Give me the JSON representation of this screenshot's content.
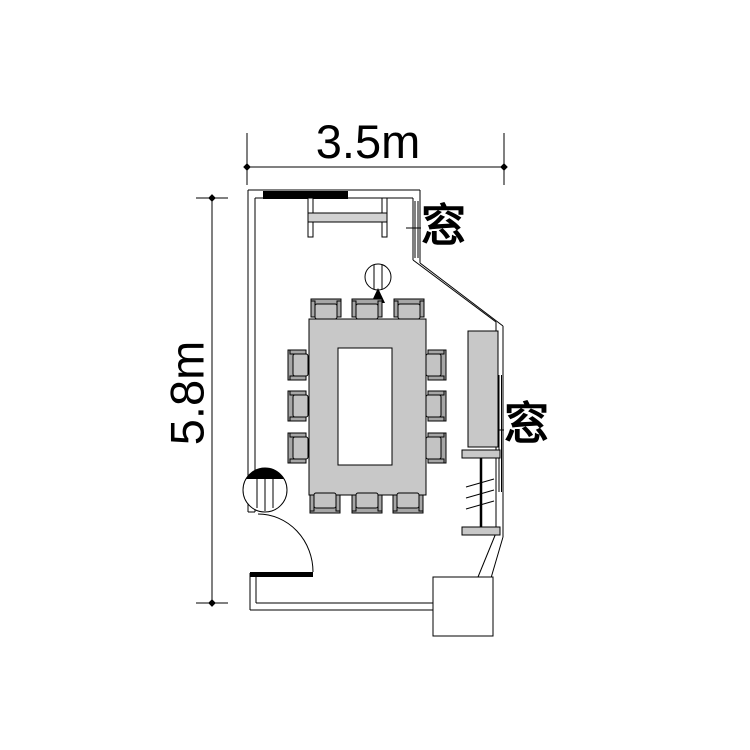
{
  "dimensions": {
    "width_label": "3.5m",
    "height_label": "5.8m",
    "width_m": 3.5,
    "height_m": 5.8
  },
  "labels": {
    "window_top": "窓",
    "window_right": "窓"
  },
  "furniture": {
    "chair_count": 12,
    "table": "ring-shaped conference table",
    "windows": 2
  },
  "symbols": {
    "door": "door-swing-arc",
    "screen": "hanging-projection-screen",
    "board": "wall-mounted-board",
    "projector": "ceiling-device-with-arrow",
    "entrance_post": "striped-column-circle",
    "sideboard": "side-board",
    "blind_box": "window-blind-section",
    "pillar": "pillar-box"
  },
  "colors": {
    "background": "#ffffff",
    "line": "#000000",
    "table_fill": "#c8c8c8",
    "chair_seat_fill": "#c3c3c3",
    "chair_back_fill": "#a6a6a6",
    "screen_bar_fill": "#d2d2d2",
    "board_fill": "#000000",
    "sideboard_fill": "#c8c8c8",
    "blind_bar_fill": "#c8c8c8",
    "pillar_fill": "#ffffff"
  }
}
